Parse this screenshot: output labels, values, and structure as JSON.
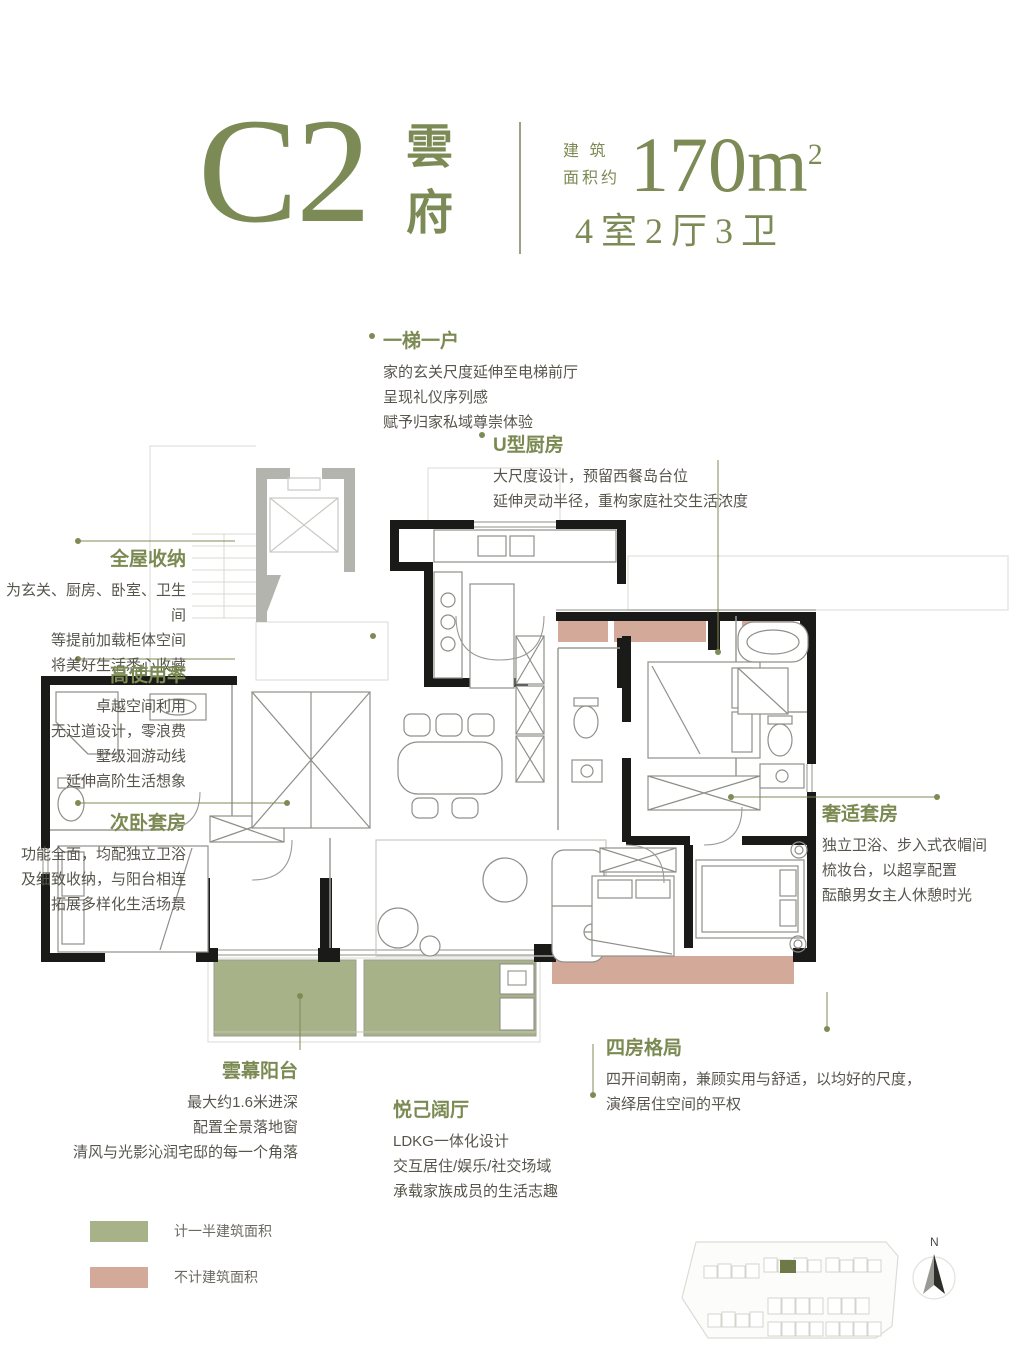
{
  "header": {
    "code": "C2",
    "name": "雲府",
    "area_label_line1": "建 筑",
    "area_label_line2": "面积约",
    "area_value": "170m",
    "area_unit_sup": "2",
    "rooms": "4室2厅3卫"
  },
  "colors": {
    "accent_olive": "#7c8a55",
    "body_text": "#57554c",
    "balcony_green": "#a7b289",
    "bay_pink": "#d3a99a",
    "wall_black": "#1a1a18",
    "core_gray": "#b4b4af"
  },
  "annotations": [
    {
      "id": "one-elevator-one-home",
      "title": "一梯一户",
      "lines": [
        "家的玄关尺度延伸至电梯前厅",
        "呈现礼仪序列感",
        "赋予归家私域尊崇体验"
      ]
    },
    {
      "id": "u-kitchen",
      "title": "U型厨房",
      "lines": [
        "大尺度设计，预留西餐岛台位",
        "延伸灵动半径，重构家庭社交生活浓度"
      ]
    },
    {
      "id": "whole-house-storage",
      "title": "全屋收纳",
      "lines": [
        "为玄关、厨房、卧室、卫生间",
        "等提前加载柜体空间",
        "将美好生活悉心收藏"
      ]
    },
    {
      "id": "high-efficiency",
      "title": "高使用率",
      "lines": [
        "卓越空间利用",
        "无过道设计，零浪费",
        "墅级洄游动线",
        "延伸高阶生活想象"
      ]
    },
    {
      "id": "second-bedroom-suite",
      "title": "次卧套房",
      "lines": [
        "功能全面，均配独立卫浴",
        "及细致收纳，与阳台相连",
        "拓展多样化生活场景"
      ]
    },
    {
      "id": "luxury-master-suite",
      "title": "奢适套房",
      "lines": [
        "独立卫浴、步入式衣帽间",
        "梳妆台，以超享配置",
        "酝酿男女主人休憩时光"
      ]
    },
    {
      "id": "cloud-balcony",
      "title": "雲幕阳台",
      "lines": [
        "最大约1.6米进深",
        "配置全景落地窗",
        "清风与光影沁润宅邸的每一个角落"
      ]
    },
    {
      "id": "pleasing-living-room",
      "title": "悦己阔厅",
      "lines": [
        "LDKG一体化设计",
        "交互居住/娱乐/社交场域",
        "承载家族成员的生活志趣"
      ]
    },
    {
      "id": "four-room-layout",
      "title": "四房格局",
      "lines": [
        "四开间朝南，兼顾实用与舒适，以均好的尺度，",
        "演绎居住空间的平权"
      ]
    }
  ],
  "legend": [
    {
      "label": "计一半建筑面积",
      "color": "#a7b289"
    },
    {
      "label": "不计建筑面积",
      "color": "#d3a99a"
    }
  ],
  "site_plan": {
    "north_label": "N"
  }
}
